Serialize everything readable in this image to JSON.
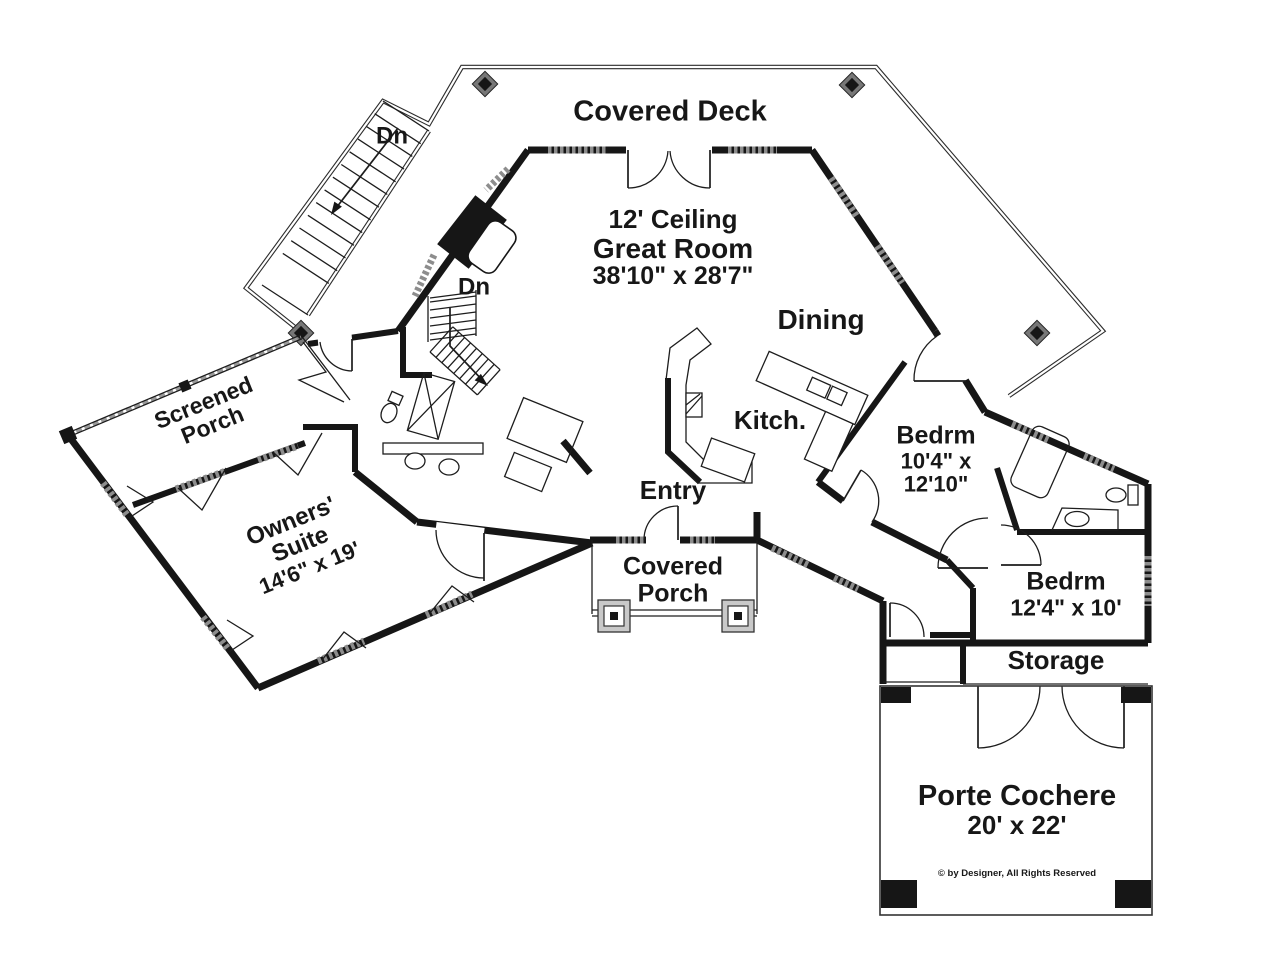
{
  "colors": {
    "ink": "#161616",
    "window_gray": "#8d8d8d",
    "post_gray": "#777777",
    "background": "#ffffff"
  },
  "labels": {
    "covered_deck": "Covered Deck",
    "stair_down_exterior": "Dn",
    "stair_down_interior": "Dn",
    "great_room": {
      "ceiling": "12' Ceiling",
      "name": "Great Room",
      "dims": "38'10\" x 28'7\""
    },
    "dining": "Dining",
    "kitchen": "Kitch.",
    "entry": "Entry",
    "covered_porch": {
      "line1": "Covered",
      "line2": "Porch"
    },
    "screened_porch": {
      "line1": "Screened",
      "line2": "Porch"
    },
    "owners_suite": {
      "line1": "Owners'",
      "line2": "Suite",
      "dims": "14'6\" x 19'"
    },
    "bedroom_1": {
      "name": "Bedrm",
      "dims_line1": "10'4\" x",
      "dims_line2": "12'10\""
    },
    "bedroom_2": {
      "name": "Bedrm",
      "dims": "12'4\" x 10'"
    },
    "storage": "Storage",
    "porte_cochere": {
      "name": "Porte Cochere",
      "dims": "20' x 22'"
    },
    "copyright": "© by Designer, All Rights Reserved"
  }
}
